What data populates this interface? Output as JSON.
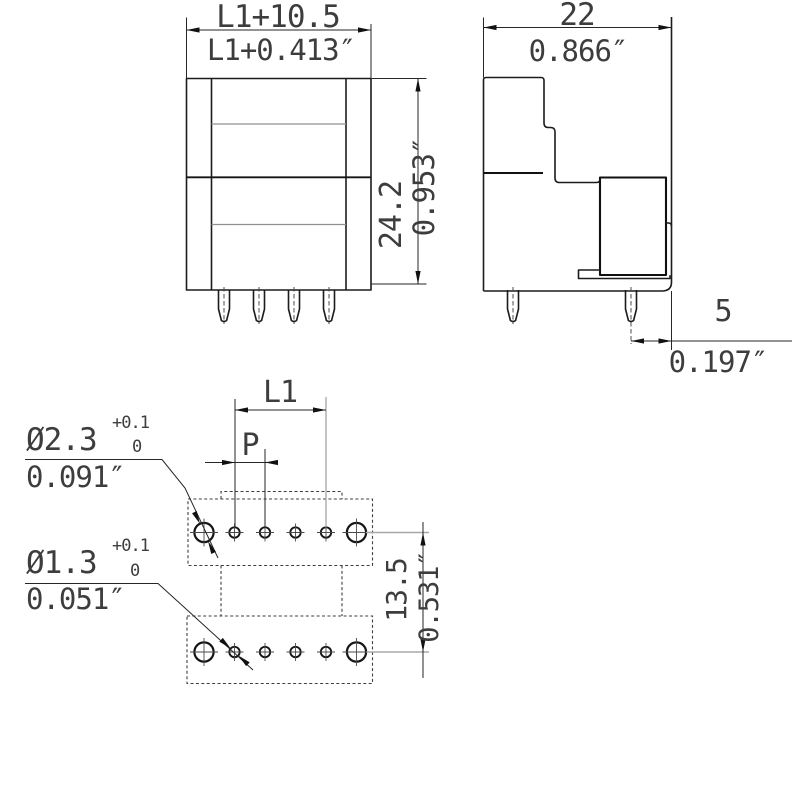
{
  "front_view": {
    "width_mm": "L1+10.5",
    "width_in": "L1+0.413″",
    "height_mm": "24.2",
    "height_in": "0.953″"
  },
  "side_view": {
    "width_mm": "22",
    "width_in": "0.866″",
    "pin_offset_mm": "5",
    "pin_offset_in": "0.197″"
  },
  "drill_plan": {
    "l1_label": "L1",
    "pitch_label": "P",
    "row_spacing_mm": "13.5",
    "row_spacing_in": "0.531″",
    "hole_a_dia": "Ø2.3",
    "hole_a_tol_upper": "+0.1",
    "hole_a_tol_lower": "0",
    "hole_a_in": "0.091″",
    "hole_b_dia": "Ø1.3",
    "hole_b_tol_upper": "+0.1",
    "hole_b_tol_lower": "0",
    "hole_b_in": "0.051″"
  },
  "colors": {
    "line": "#1c1c1c",
    "text": "#3d3d3d",
    "dashed_outline": "#3f3f3f",
    "light_line": "#a8a8a8",
    "background": "#ffffff"
  }
}
